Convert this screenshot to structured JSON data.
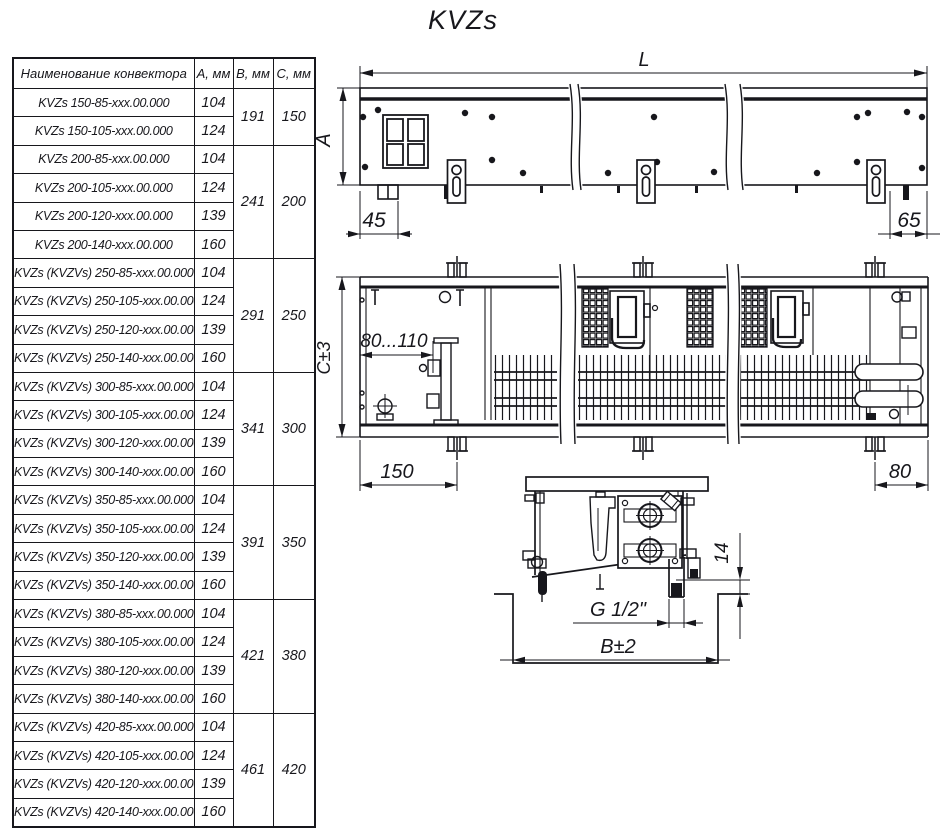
{
  "title": "KVZs",
  "table": {
    "headers": [
      "Наименование конвектора",
      "А, мм",
      "В, мм",
      "С, мм"
    ],
    "groups": [
      {
        "b": "191",
        "c": "150",
        "rows": [
          {
            "name": "KVZs 150-85-xxx.00.000",
            "a": "104"
          },
          {
            "name": "KVZs 150-105-xxx.00.000",
            "a": "124"
          }
        ]
      },
      {
        "b": "241",
        "c": "200",
        "rows": [
          {
            "name": "KVZs 200-85-xxx.00.000",
            "a": "104"
          },
          {
            "name": "KVZs 200-105-xxx.00.000",
            "a": "124"
          },
          {
            "name": "KVZs 200-120-xxx.00.000",
            "a": "139"
          },
          {
            "name": "KVZs 200-140-xxx.00.000",
            "a": "160"
          }
        ]
      },
      {
        "b": "291",
        "c": "250",
        "rows": [
          {
            "name": "KVZs (KVZVs) 250-85-xxx.00.000",
            "a": "104"
          },
          {
            "name": "KVZs (KVZVs) 250-105-xxx.00.000",
            "a": "124"
          },
          {
            "name": "KVZs (KVZVs) 250-120-xxx.00.000",
            "a": "139"
          },
          {
            "name": "KVZs (KVZVs) 250-140-xxx.00.000",
            "a": "160"
          }
        ]
      },
      {
        "b": "341",
        "c": "300",
        "rows": [
          {
            "name": "KVZs (KVZVs) 300-85-xxx.00.000",
            "a": "104"
          },
          {
            "name": "KVZs (KVZVs) 300-105-xxx.00.000",
            "a": "124"
          },
          {
            "name": "KVZs (KVZVs) 300-120-xxx.00.000",
            "a": "139"
          },
          {
            "name": "KVZs (KVZVs) 300-140-xxx.00.000",
            "a": "160"
          }
        ]
      },
      {
        "b": "391",
        "c": "350",
        "rows": [
          {
            "name": "KVZs (KVZVs) 350-85-xxx.00.000",
            "a": "104"
          },
          {
            "name": "KVZs (KVZVs) 350-105-xxx.00.000",
            "a": "124"
          },
          {
            "name": "KVZs (KVZVs) 350-120-xxx.00.000",
            "a": "139"
          },
          {
            "name": "KVZs (KVZVs) 350-140-xxx.00.000",
            "a": "160"
          }
        ]
      },
      {
        "b": "421",
        "c": "380",
        "rows": [
          {
            "name": "KVZs (KVZVs) 380-85-xxx.00.000",
            "a": "104"
          },
          {
            "name": "KVZs (KVZVs) 380-105-xxx.00.000",
            "a": "124"
          },
          {
            "name": "KVZs (KVZVs) 380-120-xxx.00.000",
            "a": "139"
          },
          {
            "name": "KVZs (KVZVs) 380-140-xxx.00.000",
            "a": "160"
          }
        ]
      },
      {
        "b": "461",
        "c": "420",
        "rows": [
          {
            "name": "KVZs (KVZVs) 420-85-xxx.00.000",
            "a": "104"
          },
          {
            "name": "KVZs (KVZVs) 420-105-xxx.00.000",
            "a": "124"
          },
          {
            "name": "KVZs (KVZVs) 420-120-xxx.00.000",
            "a": "139"
          },
          {
            "name": "KVZs (KVZVs) 420-140-xxx.00.000",
            "a": "160"
          }
        ]
      }
    ]
  },
  "drawings": {
    "front_view": {
      "label_l": "L",
      "label_a": "А",
      "label_45": "45",
      "label_65": "65"
    },
    "plan_view": {
      "label_c": "С±3",
      "label_range": "80...110",
      "label_150": "150",
      "label_80": "80"
    },
    "section_view": {
      "label_14": "14",
      "label_thread": "G 1/2\"",
      "label_b": "B±2"
    }
  },
  "colors": {
    "ink": "#17171c",
    "paper": "#ffffff"
  }
}
